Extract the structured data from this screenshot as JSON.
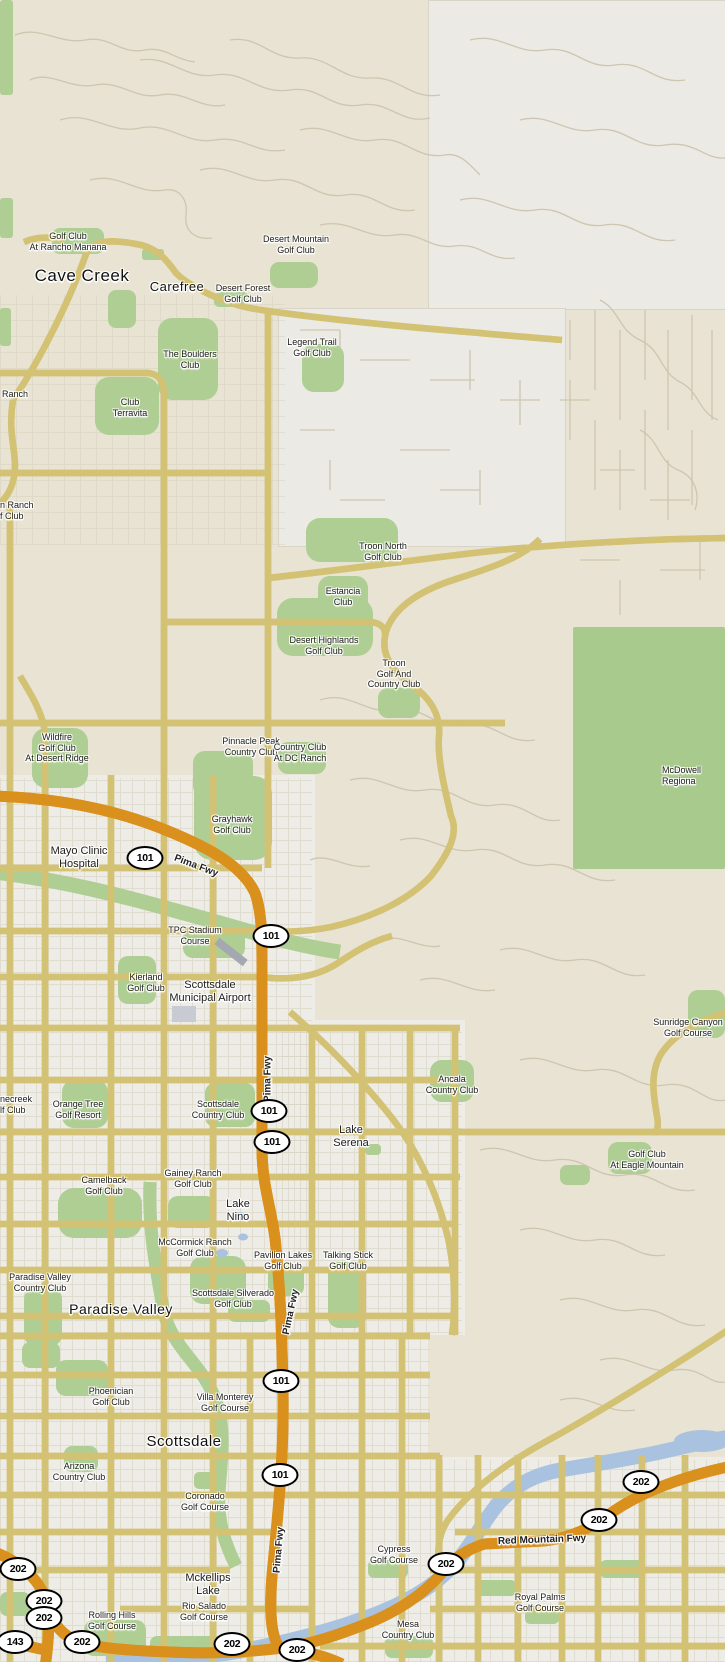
{
  "map": {
    "region": "Scottsdale / Cave Creek / Carefree / Paradise Valley / Mesa, Arizona area",
    "colors": {
      "desert": "#e8e3d2",
      "plain": "#eceae4",
      "urban": "#edece6",
      "park_green": "#afce94",
      "big_park_green": "#a9ca8d",
      "road_yellow": "#ffe87e",
      "road_yellow_border": "#d3c273",
      "freeway_orange": "#f5a733",
      "freeway_border": "#d9901c",
      "water_blue": "#a9c2e0",
      "minor_road": "#cdc6b0",
      "label_black": "#1c1c1c",
      "halo_white": "#ffffff"
    },
    "labels": [
      {
        "id": "city-cave-creek",
        "type": "city",
        "x": 82,
        "y": 266,
        "size": 17,
        "lines": [
          "Cave Creek"
        ]
      },
      {
        "id": "city-carefree",
        "type": "city",
        "x": 177,
        "y": 279,
        "size": 13,
        "lines": [
          "Carefree"
        ]
      },
      {
        "id": "city-paradise-valley",
        "type": "city",
        "x": 121,
        "y": 1301,
        "size": 14,
        "lines": [
          "Paradise Valley"
        ]
      },
      {
        "id": "city-scottsdale",
        "type": "city",
        "x": 184,
        "y": 1433,
        "size": 15,
        "lines": [
          "Scottsdale"
        ]
      },
      {
        "id": "place-mayo-clinic",
        "type": "place",
        "x": 79,
        "y": 845,
        "lines": [
          "Mayo Clinic",
          "Hospital"
        ]
      },
      {
        "id": "place-scottsdale-municipal-airport",
        "type": "place",
        "x": 210,
        "y": 979,
        "lines": [
          "Scottsdale",
          "Municipal Airport"
        ]
      },
      {
        "id": "place-lake-serena",
        "type": "place",
        "x": 351,
        "y": 1124,
        "lines": [
          "Lake",
          "Serena"
        ]
      },
      {
        "id": "place-lake-nino",
        "type": "place",
        "x": 238,
        "y": 1198,
        "lines": [
          "Lake",
          "Nino"
        ]
      },
      {
        "id": "place-mckellips-lake",
        "type": "place",
        "x": 208,
        "y": 1572,
        "lines": [
          "Mckellips",
          "Lake"
        ]
      },
      {
        "id": "poi-rancho-manana",
        "type": "poi",
        "x": 68,
        "y": 231,
        "lines": [
          "Golf Club",
          "At Rancho Manana"
        ]
      },
      {
        "id": "poi-desert-mountain",
        "type": "poi",
        "x": 296,
        "y": 234,
        "lines": [
          "Desert Mountain",
          "Golf Club"
        ]
      },
      {
        "id": "poi-desert-forest",
        "type": "poi",
        "x": 243,
        "y": 283,
        "lines": [
          "Desert Forest",
          "Golf Club"
        ]
      },
      {
        "id": "poi-the-boulders",
        "type": "poi",
        "x": 190,
        "y": 349,
        "lines": [
          "The Boulders",
          "Club"
        ]
      },
      {
        "id": "poi-legend-trail",
        "type": "poi",
        "x": 312,
        "y": 337,
        "lines": [
          "Legend Trail",
          "Golf Club"
        ]
      },
      {
        "id": "poi-club-terravita",
        "type": "poi",
        "x": 130,
        "y": 397,
        "lines": [
          "Club",
          "Terravita"
        ]
      },
      {
        "id": "poi-troon-north",
        "type": "poi",
        "x": 383,
        "y": 541,
        "lines": [
          "Troon North",
          "Golf Club"
        ]
      },
      {
        "id": "poi-estancia",
        "type": "poi",
        "x": 343,
        "y": 586,
        "lines": [
          "Estancia",
          "Club"
        ]
      },
      {
        "id": "poi-desert-highlands",
        "type": "poi",
        "x": 324,
        "y": 635,
        "lines": [
          "Desert Highlands",
          "Golf Club"
        ]
      },
      {
        "id": "poi-troon-golf-cc",
        "type": "poi",
        "x": 394,
        "y": 658,
        "lines": [
          "Troon",
          "Golf And",
          "Country Club"
        ]
      },
      {
        "id": "poi-pinnacle-peak",
        "type": "poi",
        "x": 251,
        "y": 736,
        "lines": [
          "Pinnacle Peak",
          "Country Club"
        ]
      },
      {
        "id": "poi-wildfire",
        "type": "poi",
        "x": 57,
        "y": 732,
        "lines": [
          "Wildfire",
          "Golf Club",
          "At Desert Ridge"
        ]
      },
      {
        "id": "poi-dc-ranch",
        "type": "poi",
        "x": 300,
        "y": 742,
        "lines": [
          "Country Club",
          "At DC Ranch"
        ]
      },
      {
        "id": "poi-grayhawk",
        "type": "poi",
        "x": 232,
        "y": 814,
        "lines": [
          "Grayhawk",
          "Golf Club"
        ]
      },
      {
        "id": "poi-tpc-stadium",
        "type": "poi",
        "x": 195,
        "y": 925,
        "lines": [
          "TPC Stadium",
          "Course"
        ]
      },
      {
        "id": "poi-kierland",
        "type": "poi",
        "x": 146,
        "y": 972,
        "lines": [
          "Kierland",
          "Golf Club"
        ]
      },
      {
        "id": "poi-sunridge-canyon",
        "type": "poi",
        "x": 688,
        "y": 1017,
        "lines": [
          "Sunridge Canyon",
          "Golf Course"
        ]
      },
      {
        "id": "poi-orange-tree",
        "type": "poi",
        "x": 78,
        "y": 1099,
        "lines": [
          "Orange Tree",
          "Golf Resort"
        ]
      },
      {
        "id": "poi-scottsdale-cc",
        "type": "poi",
        "x": 218,
        "y": 1099,
        "lines": [
          "Scottsdale",
          "Country Club"
        ]
      },
      {
        "id": "poi-ancala",
        "type": "poi",
        "x": 452,
        "y": 1074,
        "lines": [
          "Ancala",
          "Country Club"
        ]
      },
      {
        "id": "poi-camelback",
        "type": "poi",
        "x": 104,
        "y": 1175,
        "lines": [
          "Camelback",
          "Golf Club"
        ]
      },
      {
        "id": "poi-gainey-ranch",
        "type": "poi",
        "x": 193,
        "y": 1168,
        "lines": [
          "Gainey Ranch",
          "Golf Club"
        ]
      },
      {
        "id": "poi-mccormick-ranch",
        "type": "poi",
        "x": 195,
        "y": 1237,
        "lines": [
          "McCormick Ranch",
          "Golf Club"
        ]
      },
      {
        "id": "poi-pavilion-lakes",
        "type": "poi",
        "x": 283,
        "y": 1250,
        "lines": [
          "Pavilion Lakes",
          "Golf Club"
        ]
      },
      {
        "id": "poi-talking-stick",
        "type": "poi",
        "x": 348,
        "y": 1250,
        "lines": [
          "Talking Stick",
          "Golf Club"
        ]
      },
      {
        "id": "poi-scottsdale-silverado",
        "type": "poi",
        "x": 233,
        "y": 1288,
        "lines": [
          "Scottsdale Silverado",
          "Golf Club"
        ]
      },
      {
        "id": "poi-paradise-valley-cc",
        "type": "poi",
        "x": 40,
        "y": 1272,
        "lines": [
          "Paradise Valley",
          "Country Club"
        ]
      },
      {
        "id": "poi-eagle-mountain",
        "type": "poi",
        "x": 647,
        "y": 1149,
        "lines": [
          "Golf Club",
          "At Eagle Mountain"
        ]
      },
      {
        "id": "poi-phoenician",
        "type": "poi",
        "x": 111,
        "y": 1386,
        "lines": [
          "Phoenician",
          "Golf Club"
        ]
      },
      {
        "id": "poi-villa-monterey",
        "type": "poi",
        "x": 225,
        "y": 1392,
        "lines": [
          "Villa Monterey",
          "Golf Course"
        ]
      },
      {
        "id": "poi-arizona-cc",
        "type": "poi",
        "x": 79,
        "y": 1461,
        "lines": [
          "Arizona",
          "Country Club"
        ]
      },
      {
        "id": "poi-coronado",
        "type": "poi",
        "x": 205,
        "y": 1491,
        "lines": [
          "Coronado",
          "Golf Course"
        ]
      },
      {
        "id": "poi-cypress",
        "type": "poi",
        "x": 394,
        "y": 1544,
        "lines": [
          "Cypress",
          "Golf Course"
        ]
      },
      {
        "id": "poi-royal-palms",
        "type": "poi",
        "x": 540,
        "y": 1592,
        "lines": [
          "Royal Palms",
          "Golf Course"
        ]
      },
      {
        "id": "poi-rolling-hills",
        "type": "poi",
        "x": 112,
        "y": 1610,
        "lines": [
          "Rolling Hills",
          "Golf Course"
        ]
      },
      {
        "id": "poi-rio-salado",
        "type": "poi",
        "x": 204,
        "y": 1601,
        "lines": [
          "Rio Salado",
          "Golf Course"
        ]
      },
      {
        "id": "poi-mesa-cc",
        "type": "poi",
        "x": 408,
        "y": 1619,
        "lines": [
          "Mesa",
          "Country Club"
        ]
      },
      {
        "id": "poi-mcdowell-regional-partial",
        "type": "poi",
        "x": 662,
        "y": 765,
        "align": "left",
        "lines": [
          "McDowell",
          "Regiona"
        ]
      },
      {
        "id": "poi-ranch-partial",
        "type": "poi",
        "x": 2,
        "y": 389,
        "align": "left",
        "lines": [
          "Ranch"
        ]
      },
      {
        "id": "poi-tatum-ranch-partial",
        "type": "poi",
        "x": 0,
        "y": 500,
        "align": "left",
        "lines": [
          "n Ranch",
          "f Club"
        ]
      },
      {
        "id": "poi-stonecreek-partial",
        "type": "poi",
        "x": 0,
        "y": 1094,
        "align": "left",
        "lines": [
          "necreek",
          "lf Club"
        ]
      },
      {
        "id": "fwy-pima-1",
        "type": "fwy",
        "x": 196,
        "y": 866,
        "rotate": 21,
        "lines": [
          "Pima Fwy"
        ]
      },
      {
        "id": "fwy-pima-2",
        "type": "fwy",
        "x": 268,
        "y": 1079,
        "rotate": -90,
        "lines": [
          "Pima Fwy"
        ]
      },
      {
        "id": "fwy-pima-3",
        "type": "fwy",
        "x": 291,
        "y": 1312,
        "rotate": -78,
        "lines": [
          "Pima Fwy"
        ]
      },
      {
        "id": "fwy-pima-4",
        "type": "fwy",
        "x": 279,
        "y": 1550,
        "rotate": -85,
        "lines": [
          "Pima Fwy"
        ]
      },
      {
        "id": "fwy-red-mountain",
        "type": "fwy",
        "x": 542,
        "y": 1540,
        "rotate": -2,
        "lines": [
          "Red Mountain Fwy"
        ]
      }
    ],
    "shields": [
      {
        "text": "101",
        "x": 145,
        "y": 858
      },
      {
        "text": "101",
        "x": 271,
        "y": 936
      },
      {
        "text": "101",
        "x": 269,
        "y": 1111
      },
      {
        "text": "101",
        "x": 272,
        "y": 1142
      },
      {
        "text": "101",
        "x": 281,
        "y": 1381
      },
      {
        "text": "101",
        "x": 280,
        "y": 1475
      },
      {
        "text": "202",
        "x": 641,
        "y": 1482
      },
      {
        "text": "202",
        "x": 599,
        "y": 1520
      },
      {
        "text": "202",
        "x": 446,
        "y": 1564
      },
      {
        "text": "202",
        "x": 18,
        "y": 1569
      },
      {
        "text": "202",
        "x": 44,
        "y": 1601
      },
      {
        "text": "202",
        "x": 44,
        "y": 1618
      },
      {
        "text": "143",
        "x": 15,
        "y": 1642
      },
      {
        "text": "202",
        "x": 82,
        "y": 1642
      },
      {
        "text": "202",
        "x": 232,
        "y": 1644
      },
      {
        "text": "202",
        "x": 297,
        "y": 1650
      }
    ]
  }
}
